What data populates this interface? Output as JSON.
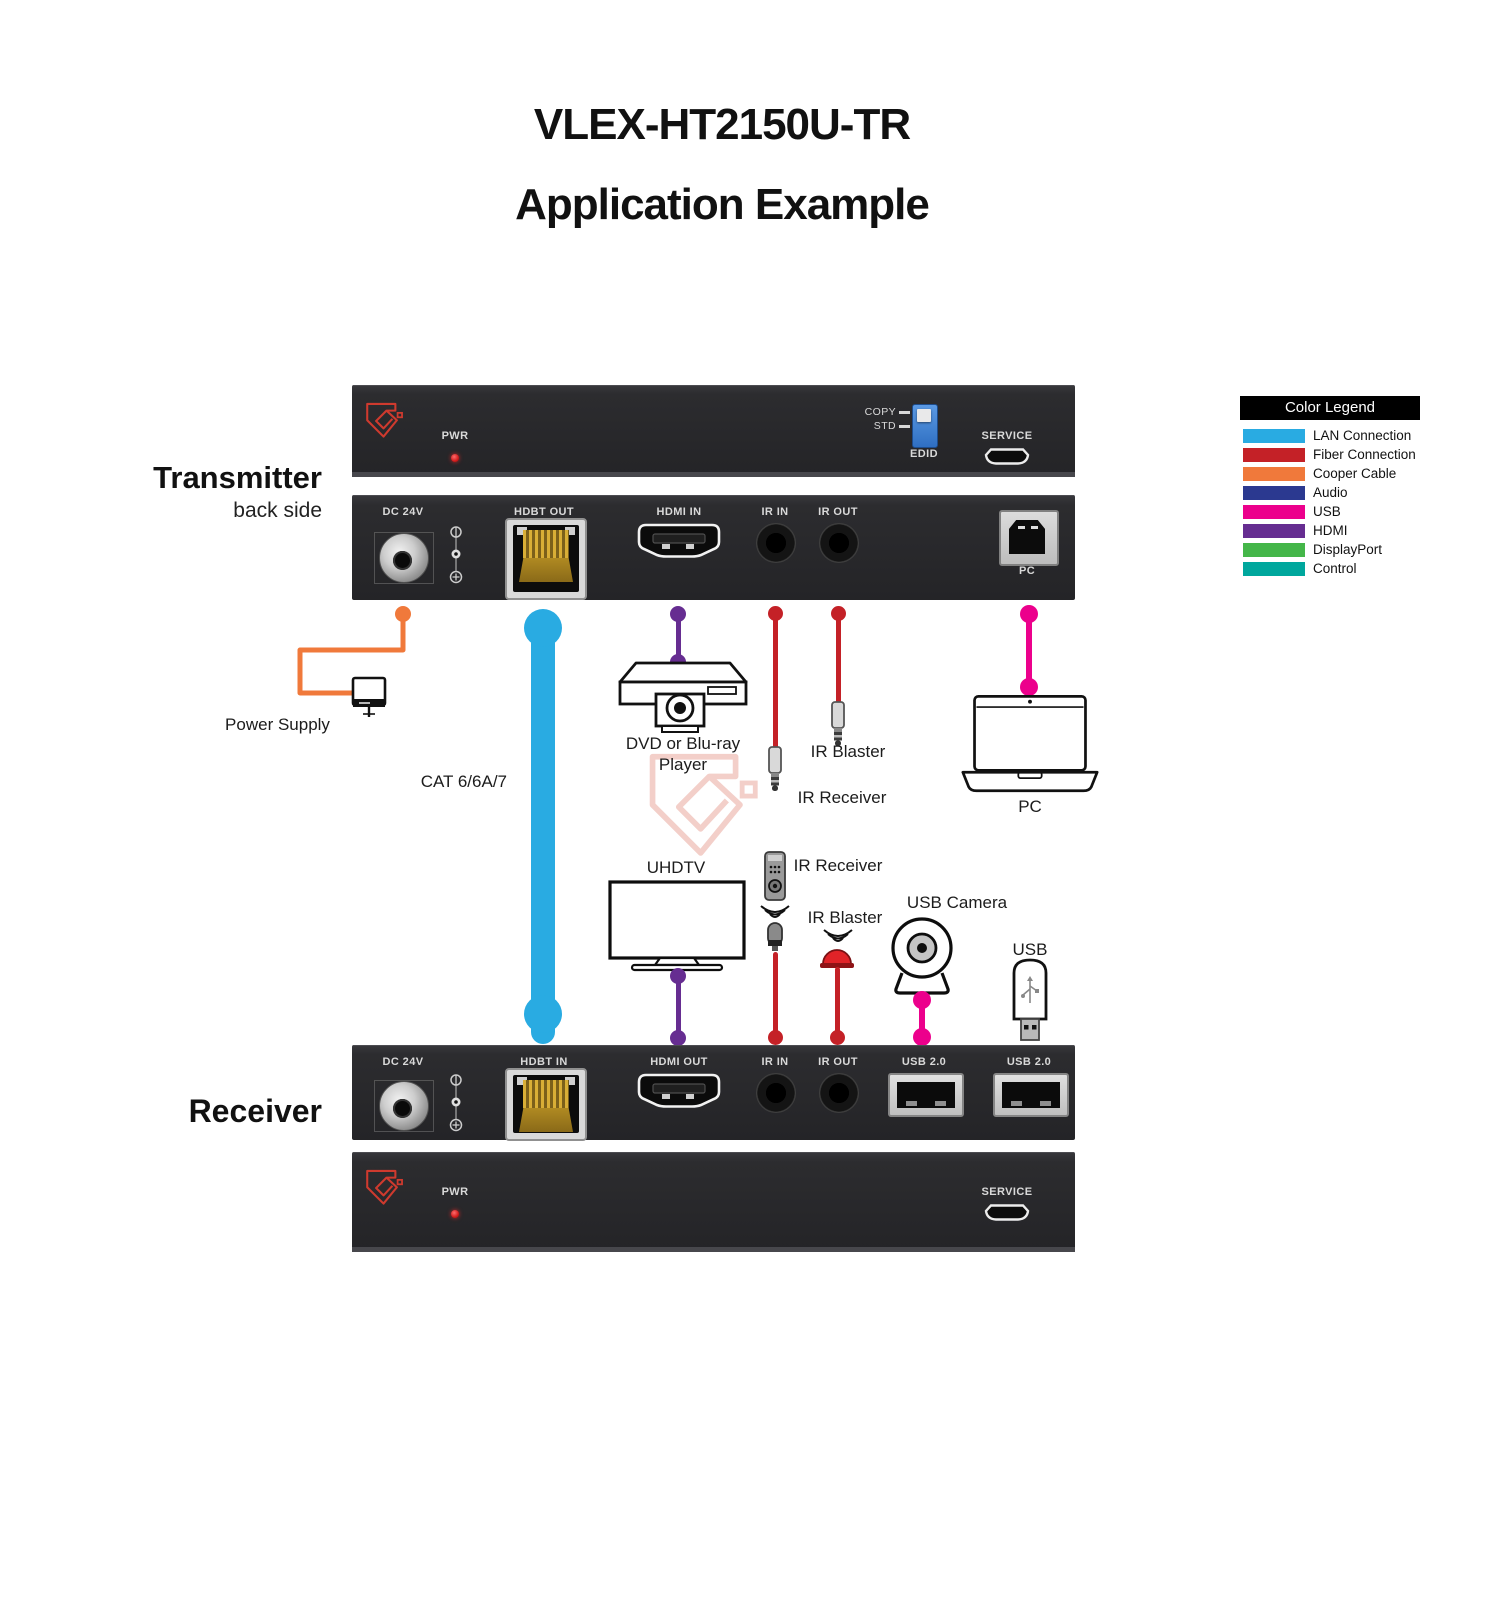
{
  "page": {
    "title_line1": "VLEX-HT2150U-TR",
    "title_line2": "Application Example"
  },
  "device_labels": {
    "transmitter": "Transmitter",
    "transmitter_sub": "back side",
    "receiver": "Receiver"
  },
  "transmitter_front": {
    "pwr": "PWR",
    "copy": "COPY",
    "std": "STD",
    "edid": "EDID",
    "service": "SERVICE"
  },
  "transmitter_back": {
    "dc": "DC 24V",
    "hdbt": "HDBT OUT",
    "hdmi": "HDMI IN",
    "ir_in": "IR IN",
    "ir_out": "IR OUT",
    "pc": "PC"
  },
  "receiver_back": {
    "dc": "DC 24V",
    "hdbt": "HDBT IN",
    "hdmi": "HDMI OUT",
    "ir_in": "IR IN",
    "ir_out": "IR OUT",
    "usb1": "USB 2.0",
    "usb2": "USB 2.0"
  },
  "receiver_front": {
    "pwr": "PWR",
    "service": "SERVICE"
  },
  "connections": {
    "power_supply": "Power Supply",
    "cat_cable": "CAT 6/6A/7",
    "dvd_line1": "DVD or Blu-ray",
    "dvd_line2": "Player",
    "ir_blaster_top": "IR Blaster",
    "ir_receiver_top": "IR Receiver",
    "pc_device": "PC",
    "uhdtv": "UHDTV",
    "ir_receiver_bottom": "IR Receiver",
    "ir_blaster_bottom": "IR Blaster",
    "usb_camera": "USB Camera",
    "usb_drive": "USB"
  },
  "legend": {
    "title": "Color Legend",
    "items": [
      {
        "label": "LAN Connection",
        "color": "#29ABE2"
      },
      {
        "label": "Fiber Connection",
        "color": "#C42127"
      },
      {
        "label": "Cooper Cable",
        "color": "#F0793B"
      },
      {
        "label": "Audio",
        "color": "#2B3990"
      },
      {
        "label": "USB",
        "color": "#EC008C"
      },
      {
        "label": "HDMI",
        "color": "#662D91"
      },
      {
        "label": "DisplayPort",
        "color": "#44B649"
      },
      {
        "label": "Control",
        "color": "#00A79D"
      }
    ]
  },
  "line_colors": {
    "lan": "#29ABE2",
    "copper": "#F0793B",
    "hdmi": "#662D91",
    "ir": "#C42127",
    "usb": "#EC008C"
  }
}
